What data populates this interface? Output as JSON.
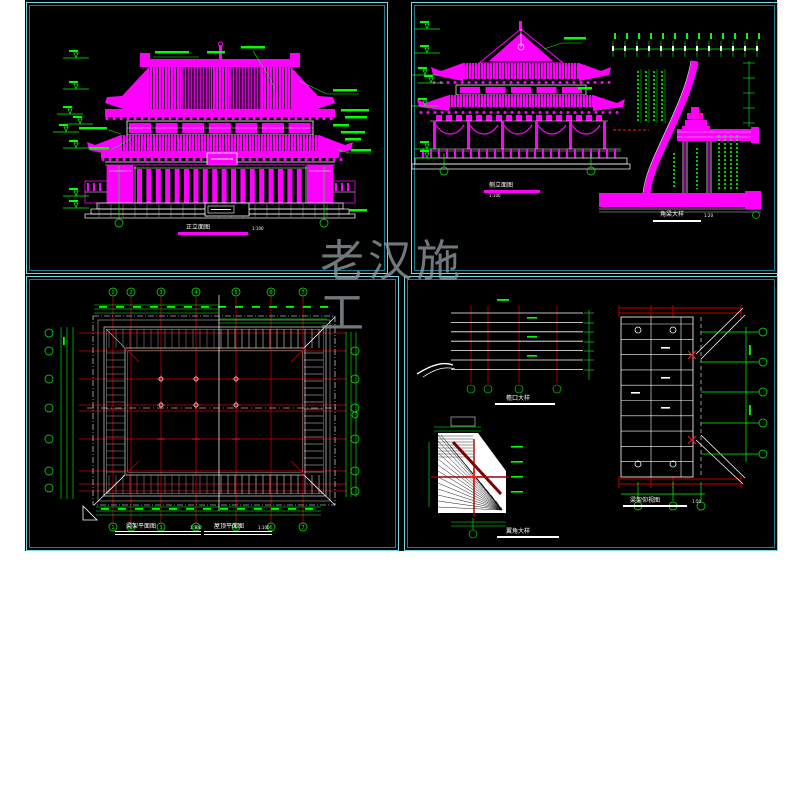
{
  "watermark": {
    "text": "老汉施工"
  },
  "colors": {
    "page": "#ffffff",
    "background": "#000000",
    "border_outer": "#79d9e6",
    "border_inner": "#1e7f92",
    "magenta": "#ff00ff",
    "green": "#00ff00",
    "dark_red": "#9b0000",
    "red": "#ff1a1a",
    "gray": "#9a9a9a",
    "white": "#ffffff",
    "watermark_gray": "#8d969b"
  },
  "panels": {
    "front_elevation": {
      "title": "正立面图",
      "scale": "1:100",
      "axis_bubbles": [
        "1",
        "7"
      ]
    },
    "side_elevation": {
      "title": "侧立面图",
      "scale": "1:100",
      "axis_bubbles": [
        "A",
        "D"
      ]
    },
    "corner_beam_section": {
      "title": "角梁大样",
      "scale": "1:20"
    },
    "roof_plan": {
      "title_left": "梁架平面图",
      "scale_left": "1:100",
      "title_right": "屋顶平面图",
      "scale_right": "1:100",
      "column_axes": [
        "1",
        "2",
        "3",
        "4",
        "5",
        "6",
        "7"
      ]
    },
    "eave_detail": {
      "title": "檐口大样"
    },
    "corner_fan_detail": {
      "title": "翼角大样"
    },
    "framing_plan_detail": {
      "title": "梁架仰视图",
      "scale": "1:50"
    }
  }
}
